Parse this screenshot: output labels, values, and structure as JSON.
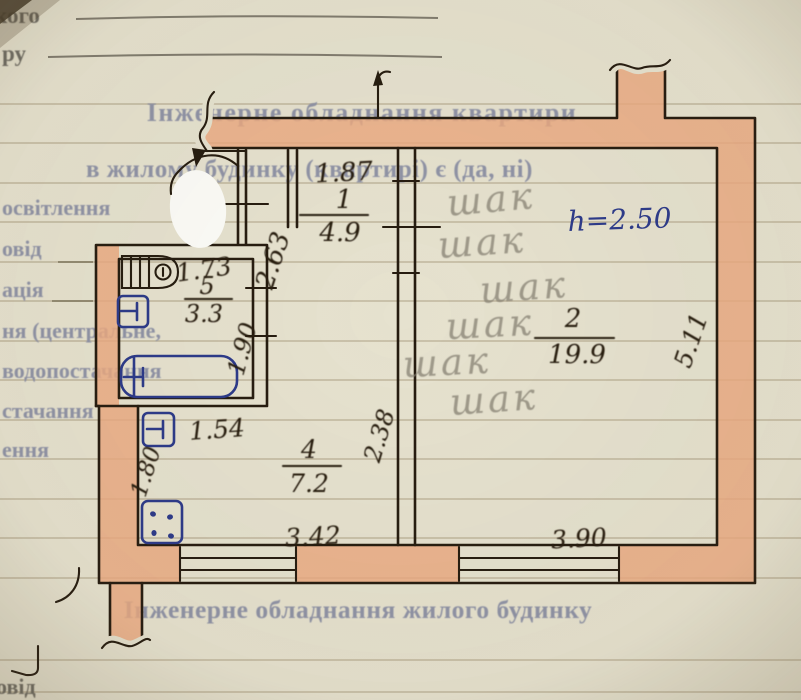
{
  "form": {
    "fragment_top_1": "кого",
    "fragment_top_2": "ру",
    "heading_apartment": "Інженерне обладнання квартири",
    "subheading_apartment": "в жилому будинку (квартирі) є (да, ні)",
    "left_labels": {
      "line1": "освітлення",
      "line2": "овід",
      "line3": "ація",
      "line4": "ня (центральне,",
      "line5": "водопостачання",
      "line6": "стачання",
      "line7": "ення"
    },
    "heading_building": "Інженерне обладнання жилого будинку",
    "fragment_bottom": "овід"
  },
  "plan": {
    "ceiling_height": "h=2.50",
    "rooms": {
      "hall": {
        "number": "1",
        "area": "4.9"
      },
      "living": {
        "number": "2",
        "area": "19.9"
      },
      "kitchen": {
        "number": "4",
        "area": "7.2"
      },
      "bathroom": {
        "number": "5",
        "area": "3.3"
      }
    },
    "dimensions": {
      "hall_width": "1.87",
      "hall_depth": "2.63",
      "bathroom_width": "1.73",
      "bathroom_depth": "1.90",
      "kitchen_niche": "1.54",
      "kitchen_left": "1.80",
      "kitchen_width": "3.42",
      "kitchen_depth": "2.38",
      "living_width": "3.90",
      "living_depth": "5.11"
    },
    "pencil_notes": [
      "шак",
      "шак",
      "шак",
      "шак",
      "шак",
      "шак"
    ]
  },
  "colors": {
    "wall_fill": "#ebaa80",
    "ink": "#261c10",
    "blue_ink": "#2c3a8a",
    "pencil": "#8a8477",
    "printed_text": "#8f93a6",
    "paper": "#e6e2cf"
  }
}
